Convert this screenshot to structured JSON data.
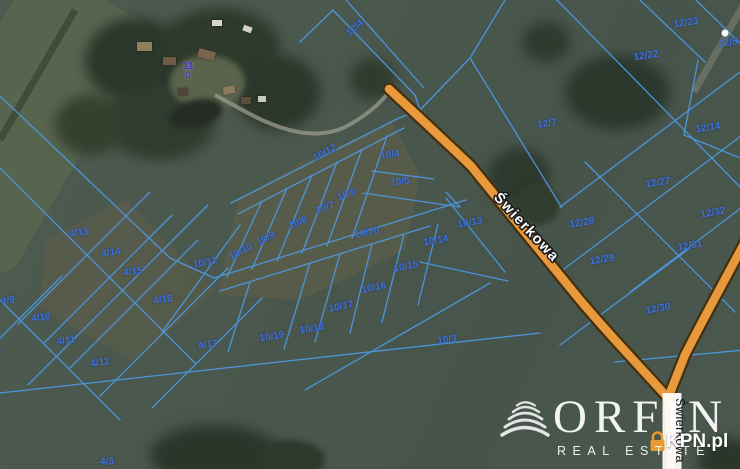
{
  "map_type": "cadastral-satellite-map",
  "streets": {
    "main": "Świerkowa",
    "branch": "Świerkowa"
  },
  "address_marker": {
    "line1": "11",
    "line2": "0"
  },
  "watermark": {
    "brand": "ORFIN",
    "tagline": "REAL ESTATE",
    "portal": "KPN.pl"
  },
  "colors": {
    "parcel_line": "#4C9BE8",
    "parcel_label": "#3F6FD8",
    "road_fill": "#E8993C",
    "road_casing": "#42300F",
    "street_text": "#FFFFFF",
    "marker_purple": "#4B2FD4"
  },
  "parcels": {
    "labels": [
      {
        "id": "4/13",
        "x": 79,
        "y": 233,
        "rot": -8
      },
      {
        "id": "4/14",
        "x": 111,
        "y": 253,
        "rot": -8
      },
      {
        "id": "4/15",
        "x": 133,
        "y": 272,
        "rot": -8
      },
      {
        "id": "4/16",
        "x": 163,
        "y": 300,
        "rot": -8
      },
      {
        "id": "4/9",
        "x": 8,
        "y": 301,
        "rot": -8
      },
      {
        "id": "4/10",
        "x": 41,
        "y": 318,
        "rot": -8
      },
      {
        "id": "4/11",
        "x": 66,
        "y": 341,
        "rot": -8
      },
      {
        "id": "4/8",
        "x": -6,
        "y": 352,
        "rot": -8
      },
      {
        "id": "4/12",
        "x": 100,
        "y": 363,
        "rot": -8
      },
      {
        "id": "4/17",
        "x": 208,
        "y": 345,
        "rot": -8
      },
      {
        "id": "4/3",
        "x": 107,
        "y": 462,
        "rot": 0
      },
      {
        "id": "10/12",
        "x": 325,
        "y": 153,
        "rot": -28
      },
      {
        "id": "10/4",
        "x": 390,
        "y": 155,
        "rot": -8
      },
      {
        "id": "10/5",
        "x": 400,
        "y": 182,
        "rot": -8
      },
      {
        "id": "10/6",
        "x": 347,
        "y": 195,
        "rot": -20
      },
      {
        "id": "10/7",
        "x": 325,
        "y": 208,
        "rot": -20
      },
      {
        "id": "10/8",
        "x": 298,
        "y": 223,
        "rot": -20
      },
      {
        "id": "10/9",
        "x": 266,
        "y": 239,
        "rot": -28
      },
      {
        "id": "10/10",
        "x": 241,
        "y": 252,
        "rot": -28
      },
      {
        "id": "10/11",
        "x": 205,
        "y": 263,
        "rot": -12
      },
      {
        "id": "10/20",
        "x": 367,
        "y": 233,
        "rot": -12
      },
      {
        "id": "10/13",
        "x": 470,
        "y": 223,
        "rot": -10
      },
      {
        "id": "10/14",
        "x": 436,
        "y": 241,
        "rot": -10
      },
      {
        "id": "10/15",
        "x": 406,
        "y": 267,
        "rot": -12
      },
      {
        "id": "10/16",
        "x": 374,
        "y": 288,
        "rot": -12
      },
      {
        "id": "10/17",
        "x": 341,
        "y": 307,
        "rot": -12
      },
      {
        "id": "10/18",
        "x": 312,
        "y": 329,
        "rot": -10
      },
      {
        "id": "10/19",
        "x": 272,
        "y": 337,
        "rot": -10
      },
      {
        "id": "10/3",
        "x": 447,
        "y": 340,
        "rot": -8
      },
      {
        "id": "12/4",
        "x": 355,
        "y": 28,
        "rot": -42
      },
      {
        "id": "12/23",
        "x": 686,
        "y": 23,
        "rot": -8
      },
      {
        "id": "12/5",
        "x": 728,
        "y": 43,
        "rot": -8
      },
      {
        "id": "12/22",
        "x": 646,
        "y": 56,
        "rot": -8
      },
      {
        "id": "12/7",
        "x": 547,
        "y": 124,
        "rot": -8
      },
      {
        "id": "12/14",
        "x": 708,
        "y": 128,
        "rot": -8
      },
      {
        "id": "12/27",
        "x": 658,
        "y": 183,
        "rot": -10
      },
      {
        "id": "12/28",
        "x": 582,
        "y": 223,
        "rot": -10
      },
      {
        "id": "12/32",
        "x": 713,
        "y": 213,
        "rot": -10
      },
      {
        "id": "12/31",
        "x": 690,
        "y": 246,
        "rot": -10
      },
      {
        "id": "12/29",
        "x": 602,
        "y": 260,
        "rot": -10
      },
      {
        "id": "12/30",
        "x": 658,
        "y": 309,
        "rot": -10
      }
    ]
  }
}
